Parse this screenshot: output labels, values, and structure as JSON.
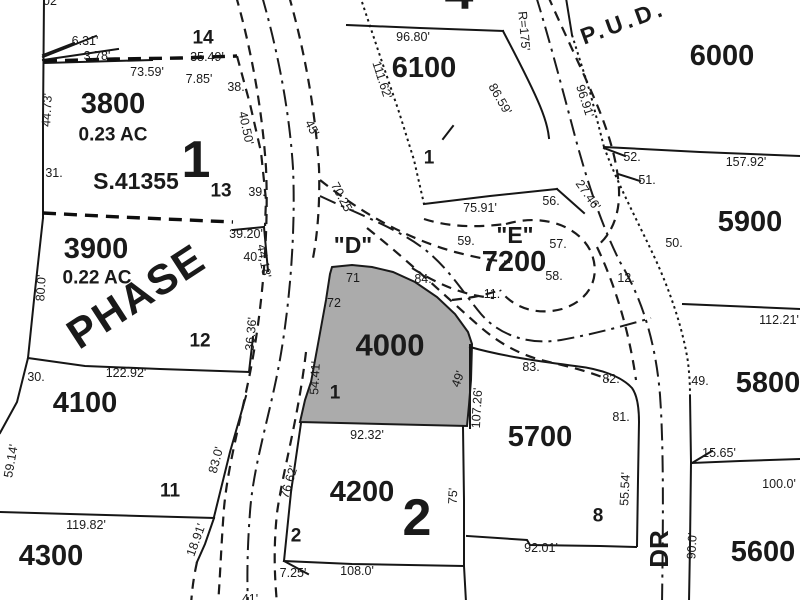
{
  "map_type": "plat-parcel-map",
  "highlight_color": "#ababab",
  "ink_color": "#1a1a1a",
  "highlighted_parcel": "4000",
  "labels": {
    "parcel_numbers": [
      {
        "text": "3800",
        "x": 113,
        "y": 104
      },
      {
        "text": "3900",
        "x": 96,
        "y": 249
      },
      {
        "text": "4100",
        "x": 85,
        "y": 403
      },
      {
        "text": "4300",
        "x": 51,
        "y": 556
      },
      {
        "text": "4000",
        "x": 390,
        "y": 345,
        "size": 31
      },
      {
        "text": "4200",
        "x": 362,
        "y": 492
      },
      {
        "text": "6100",
        "x": 424,
        "y": 68
      },
      {
        "text": "7200",
        "x": 514,
        "y": 262
      },
      {
        "text": "6000",
        "x": 722,
        "y": 56
      },
      {
        "text": "5900",
        "x": 750,
        "y": 222
      },
      {
        "text": "5800",
        "x": 768,
        "y": 383
      },
      {
        "text": "5700",
        "x": 540,
        "y": 437
      },
      {
        "text": "5600",
        "x": 763,
        "y": 552
      }
    ],
    "area_labels": [
      {
        "text": "0.23 AC",
        "x": 113,
        "y": 135
      },
      {
        "text": "0.22 AC",
        "x": 97,
        "y": 278
      }
    ],
    "block_numbers": [
      {
        "text": "1",
        "x": 196,
        "y": 160
      },
      {
        "text": "2",
        "x": 417,
        "y": 518
      },
      {
        "text": "4",
        "x": 459,
        "y": -8
      }
    ],
    "lot_numbers": [
      {
        "text": "14",
        "x": 203,
        "y": 38
      },
      {
        "text": "13",
        "x": 221,
        "y": 191
      },
      {
        "text": "12",
        "x": 200,
        "y": 341
      },
      {
        "text": "11",
        "x": 170,
        "y": 491
      },
      {
        "text": "1",
        "x": 335,
        "y": 393
      },
      {
        "text": "2",
        "x": 296,
        "y": 536
      },
      {
        "text": "1",
        "x": 429,
        "y": 158
      },
      {
        "text": "8",
        "x": 598,
        "y": 516
      }
    ],
    "text_labels": [
      {
        "text": "S.41355",
        "x": 136,
        "y": 181,
        "size": 23
      },
      {
        "text": "PHASE",
        "x": 136,
        "y": 296,
        "size": 42,
        "rot": -33,
        "fill": "#757575",
        "ls": 2
      },
      {
        "text": "P.U.D.",
        "x": 623,
        "y": 22,
        "size": 23,
        "rot": -20,
        "fill": "#3a3a3a",
        "ls": 4
      },
      {
        "text": "DR",
        "x": 659,
        "y": 549,
        "size": 26,
        "rot": -90
      },
      {
        "text": "\"D\"",
        "x": 353,
        "y": 245,
        "size": 23
      },
      {
        "text": "\"E\"",
        "x": 515,
        "y": 235,
        "size": 23
      }
    ],
    "dimensions": [
      {
        "text": "6.31'",
        "x": 85,
        "y": 41
      },
      {
        "text": "3.78'",
        "x": 97,
        "y": 56
      },
      {
        "text": "73.59'",
        "x": 147,
        "y": 72
      },
      {
        "text": "35.49'",
        "x": 207,
        "y": 57
      },
      {
        "text": "7.85'",
        "x": 199,
        "y": 79
      },
      {
        "text": "44.73'",
        "x": 47,
        "y": 110,
        "rot": -87
      },
      {
        "text": "40.50'",
        "x": 246,
        "y": 128,
        "rot": 78
      },
      {
        "text": "96.80'",
        "x": 413,
        "y": 37
      },
      {
        "text": "111.62'",
        "x": 382,
        "y": 80,
        "rot": 72
      },
      {
        "text": "R=175'",
        "x": 524,
        "y": 31,
        "rot": 85
      },
      {
        "text": "86.59'",
        "x": 500,
        "y": 99,
        "rot": 60
      },
      {
        "text": "96.91'",
        "x": 585,
        "y": 101,
        "rot": 72
      },
      {
        "text": "157.92'",
        "x": 746,
        "y": 162
      },
      {
        "text": "27.46'",
        "x": 588,
        "y": 195,
        "rot": 55
      },
      {
        "text": "75.91'",
        "x": 480,
        "y": 208
      },
      {
        "text": "45'",
        "x": 312,
        "y": 128,
        "rot": 62
      },
      {
        "text": "70.25'",
        "x": 342,
        "y": 198,
        "rot": 62
      },
      {
        "text": "39.20'",
        "x": 246,
        "y": 234
      },
      {
        "text": "44.18'",
        "x": 264,
        "y": 261,
        "rot": 80
      },
      {
        "text": "36.36'",
        "x": 251,
        "y": 334,
        "rot": -85
      },
      {
        "text": "80.0'",
        "x": 41,
        "y": 288,
        "rot": -87
      },
      {
        "text": "122.92'",
        "x": 126,
        "y": 373
      },
      {
        "text": "119.82'",
        "x": 86,
        "y": 525
      },
      {
        "text": "59.14'",
        "x": 11,
        "y": 461,
        "rot": -80
      },
      {
        "text": "83.0'",
        "x": 216,
        "y": 460,
        "rot": -75
      },
      {
        "text": "18.91'",
        "x": 196,
        "y": 540,
        "rot": -70
      },
      {
        "text": "54.41'",
        "x": 315,
        "y": 378,
        "rot": -87
      },
      {
        "text": "76.62'",
        "x": 289,
        "y": 482,
        "rot": -73
      },
      {
        "text": "92.32'",
        "x": 367,
        "y": 435
      },
      {
        "text": "107.26'",
        "x": 477,
        "y": 408,
        "rot": -87
      },
      {
        "text": "49'",
        "x": 458,
        "y": 379,
        "rot": -70
      },
      {
        "text": "75'",
        "x": 453,
        "y": 496,
        "rot": -87
      },
      {
        "text": "7.25'",
        "x": 293,
        "y": 573
      },
      {
        "text": "108.0'",
        "x": 357,
        "y": 571
      },
      {
        "text": "92.01'",
        "x": 541,
        "y": 548
      },
      {
        "text": "112.21'",
        "x": 779,
        "y": 320
      },
      {
        "text": "55.54'",
        "x": 625,
        "y": 489,
        "rot": -87
      },
      {
        "text": "15.65'",
        "x": 719,
        "y": 453
      },
      {
        "text": "100.0'",
        "x": 779,
        "y": 484
      },
      {
        "text": "90.0'",
        "x": 692,
        "y": 546,
        "rot": -87
      },
      {
        "text": "02",
        "x": 50,
        "y": 1
      },
      {
        "text": "41'",
        "x": 250,
        "y": 599
      }
    ],
    "corner_numbers": [
      {
        "text": "38.",
        "x": 236,
        "y": 87
      },
      {
        "text": "31.",
        "x": 54,
        "y": 173
      },
      {
        "text": "39.",
        "x": 257,
        "y": 192
      },
      {
        "text": "40.",
        "x": 252,
        "y": 257
      },
      {
        "text": "30.",
        "x": 36,
        "y": 377
      },
      {
        "text": "52.",
        "x": 632,
        "y": 157
      },
      {
        "text": "51.",
        "x": 647,
        "y": 180
      },
      {
        "text": "50.",
        "x": 674,
        "y": 243
      },
      {
        "text": "56.",
        "x": 551,
        "y": 201
      },
      {
        "text": "57.",
        "x": 558,
        "y": 244
      },
      {
        "text": "58.",
        "x": 554,
        "y": 276
      },
      {
        "text": "59.",
        "x": 466,
        "y": 241
      },
      {
        "text": "11.",
        "x": 492,
        "y": 294
      },
      {
        "text": "84.",
        "x": 423,
        "y": 279
      },
      {
        "text": "12.",
        "x": 626,
        "y": 278
      },
      {
        "text": "71",
        "x": 353,
        "y": 278
      },
      {
        "text": "72",
        "x": 334,
        "y": 303
      },
      {
        "text": "83.",
        "x": 531,
        "y": 367
      },
      {
        "text": "82.",
        "x": 611,
        "y": 379
      },
      {
        "text": "81.",
        "x": 621,
        "y": 417
      },
      {
        "text": "49.",
        "x": 700,
        "y": 381
      }
    ]
  }
}
